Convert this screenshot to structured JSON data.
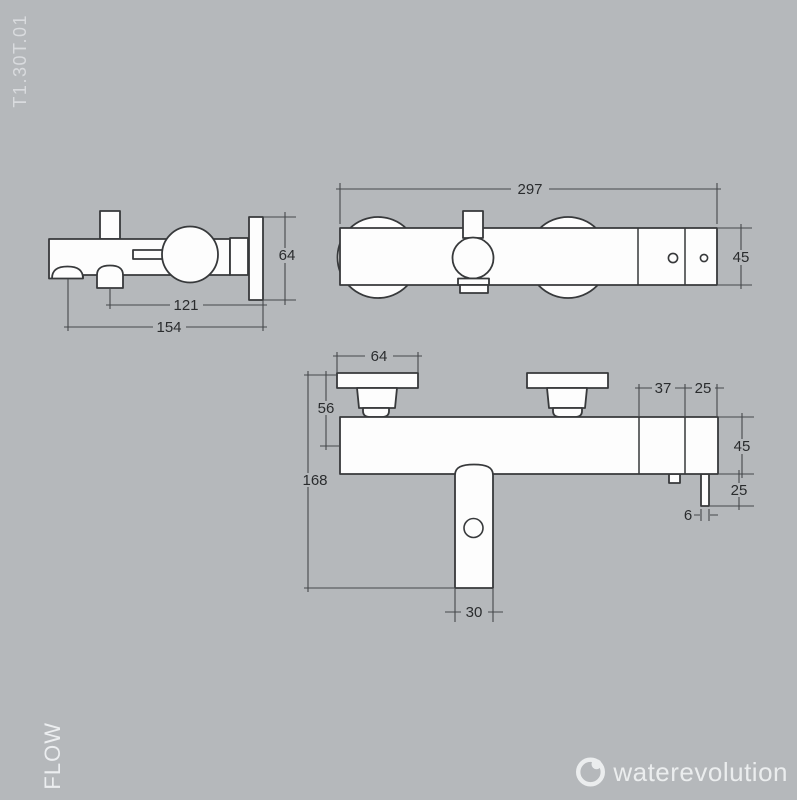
{
  "page": {
    "product_code": "T1.30T.01",
    "series_label": "FLOW",
    "brand_name": "waterevolution",
    "background_color": "#b5b8bb",
    "line_color": "#37393b",
    "dimension_text_color": "#2a2c2e",
    "shape_fill_color": "#fdfdfd"
  },
  "side_view": {
    "dim_plate_height": "64",
    "dim_spout_to_wall": "121",
    "dim_front_to_wall": "154"
  },
  "top_view": {
    "dim_total_width": "297",
    "dim_body_depth": "45"
  },
  "front_view": {
    "dim_plate_width": "64",
    "dim_plate_to_axis": "56",
    "dim_total_height": "168",
    "dim_spout_width": "30",
    "dim_segment_37": "37",
    "dim_segment_25": "25",
    "dim_body_height": "45",
    "dim_outlet_drop": "25",
    "dim_outlet_diameter": "6"
  }
}
